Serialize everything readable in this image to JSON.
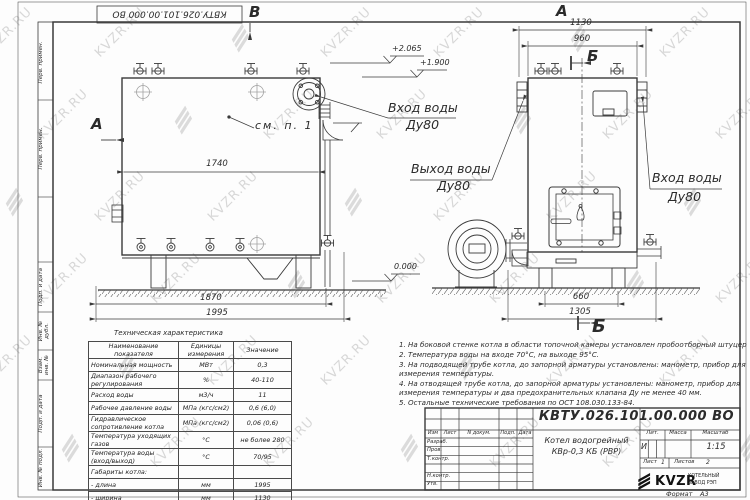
{
  "colors": {
    "line": "#3a3a3a",
    "watermark": "#b3b3b3",
    "logo_black": "#111111"
  },
  "watermark": {
    "text": "KVZR.RU"
  },
  "frame": {
    "left_column_labels": [
      "Перв. примен.",
      "Перв. примен.",
      "Подп. и дата",
      "Инв. № дубл.",
      "Взам. инв. №",
      "Подп. и дата",
      "Инв. № подл."
    ],
    "format_label": "Формат",
    "format_value": "А3"
  },
  "views": {
    "front": {
      "marker_top": "В",
      "marker_left": "А",
      "see_note": "см. п. 1",
      "label_inlet_line1": "Вход воды",
      "label_inlet_line2": "Ду80",
      "label_outlet_line1": "Выход воды",
      "label_outlet_line2": "Ду80",
      "dim_top": "1740",
      "dim_mid": "1870",
      "dim_bottom": "1995",
      "elev_high": "+2.065",
      "elev_mid": "+1.900",
      "elev_zero": "0.000"
    },
    "side": {
      "marker_top": "А",
      "marker_section_top": "Б",
      "marker_section_bottom": "Б",
      "label_inlet_line1": "Вход воды",
      "label_inlet_line2": "Ду80",
      "dim_overall_width": "1130",
      "dim_body_width": "960",
      "dim_legs": "660",
      "dim_base": "1305"
    }
  },
  "tech_table": {
    "title": "Техническая характеристика",
    "headers": [
      "Наименование показателя",
      "Единицы измерения",
      "Значение"
    ],
    "rows": [
      [
        "Номинальная мощность",
        "МВт",
        "0,3"
      ],
      [
        "Диапазон рабочего регулирования",
        "%",
        "40-110"
      ],
      [
        "Расход воды",
        "м3/ч",
        "11"
      ],
      [
        "Рабочее давление воды",
        "МПа (кгс/см2)",
        "0,6 (6,0)"
      ],
      [
        "Гидравлическое сопротивление котла",
        "МПа (кгс/см2)",
        "0,06 (0,6)"
      ],
      [
        "Температура уходящих газов",
        "°С",
        "не более 280"
      ],
      [
        "Температура воды (вход/выход)",
        "°С",
        "70/95"
      ],
      [
        "Габариты котла:",
        "",
        ""
      ],
      [
        "- длина",
        "мм",
        "1995"
      ],
      [
        "- ширина",
        "мм",
        "1130"
      ],
      [
        "- высота",
        "мм",
        "1950"
      ]
    ]
  },
  "notes": {
    "items": [
      "1. На боковой стенке котла в области топочной камеры установлен пробоотборный штуцер",
      "2. Температура воды на входе 70°С, на выходе 95°С.",
      "3. На подводящей трубе котла, до запорной арматуры установлены: манометр, прибор для измерения температуры.",
      "4. На отводящей трубе котла, до запорной арматуры установлены: манометр, прибор для измерения температуры и два предохранительных клапана Ду не менее 40 мм.",
      "5. Остальные технические требования по ОСТ 108.030.133-84."
    ]
  },
  "title_block": {
    "doc_number": "КВТУ.026.101.00.000  ВО",
    "name_line1": "Котел водогрейный",
    "name_line2": "КВр-0,3 КБ (РВР)",
    "header_cells": [
      "Изм",
      "Лист",
      "N докум.",
      "Подп.",
      "Дата"
    ],
    "row_labels": [
      "Разраб.",
      "Пров.",
      "Т.контр.",
      "",
      "Н.контр.",
      "Утв."
    ],
    "lit_label": "Лит.",
    "lit_value": "И",
    "mass_label": "Масса",
    "scale_label": "Масштаб",
    "scale_value": "1:15",
    "sheet_label": "Лист",
    "sheet_value": "1",
    "sheets_label": "Листов",
    "sheets_value": "2",
    "brand": "KVZR",
    "company_line1": "КОТЕЛЬНЫЙ",
    "company_line2": "ЗАВОД РЭП"
  }
}
